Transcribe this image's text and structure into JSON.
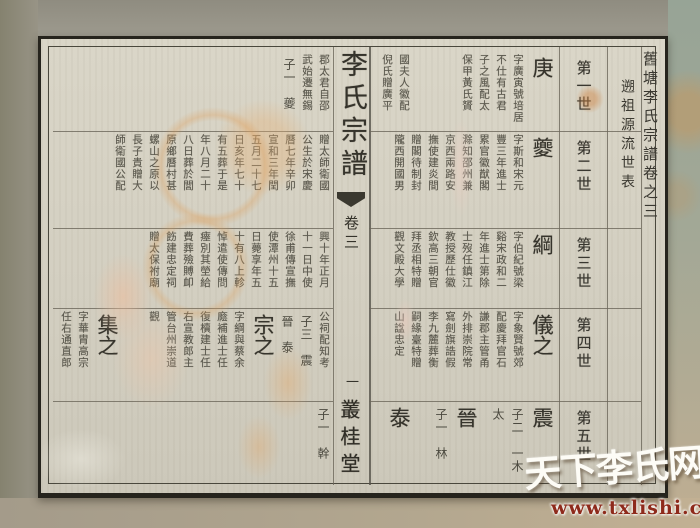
{
  "watermark": {
    "site_name": "天下李氏网",
    "site_url": "www.txlishi.com",
    "url_color": "#8e2a1b"
  },
  "colors": {
    "paper": "#d5d1c3",
    "ink": "#3a382f",
    "stain_orange": "#dca86c",
    "watermark_red": "#8e2a1b"
  },
  "spread": {
    "fold": {
      "book_title": "李氏宗譜",
      "volume_label": "卷三",
      "page_number": "一",
      "hall_name": "叢桂堂"
    },
    "right_page": {
      "edition_title": "舊塘李氏宗譜卷之三",
      "section_title": "遡祖源流世表",
      "generation_labels": [
        "第一世",
        "第二世",
        "第三世",
        "第四世",
        "第五世"
      ],
      "bands": [
        [
          [
            "name",
            "庚"
          ],
          [
            "col",
            "字廣寅號培居"
          ],
          [
            "col",
            "不仕有古君"
          ],
          [
            "col",
            "子之風配太"
          ],
          [
            "col",
            "保甲黃氏贇"
          ],
          [
            "gap",
            "44"
          ],
          [
            "col",
            "國夫人徽配"
          ],
          [
            "col",
            "倪氏贈廣平"
          ]
        ],
        [
          [
            "name",
            "夔"
          ],
          [
            "col",
            "字斯和宋元"
          ],
          [
            "col",
            "豐三年進士"
          ],
          [
            "col",
            "累官徽猷閣"
          ],
          [
            "col",
            "滁知邵州兼"
          ],
          [
            "col",
            "京西兩路安"
          ],
          [
            "col",
            "撫使建炎間"
          ],
          [
            "col",
            "贈閣待制封"
          ],
          [
            "col",
            "隴西開國男"
          ]
        ],
        [
          [
            "name",
            "綱"
          ],
          [
            "col",
            "字伯紀號梁"
          ],
          [
            "col",
            "谿宋政和二"
          ],
          [
            "col",
            "年進士第除"
          ],
          [
            "col",
            "士歿任鎮江"
          ],
          [
            "col",
            "教授歷仕徽"
          ],
          [
            "col",
            "欽高三朝官"
          ],
          [
            "col",
            "拜丞相特贈"
          ],
          [
            "col",
            "觀文殿大學"
          ]
        ],
        [
          [
            "name",
            "儀之"
          ],
          [
            "col",
            "字象賢號郊"
          ],
          [
            "col",
            "配慶拜官石"
          ],
          [
            "col",
            "謙郡主管甬"
          ],
          [
            "col",
            "外排崇院常"
          ],
          [
            "col",
            "寫劍旗誥假"
          ],
          [
            "col",
            "李九麓葬衡"
          ],
          [
            "col",
            "嗣緣臺特贈"
          ],
          [
            "col",
            "山諡忠定"
          ]
        ],
        [
          [
            "name",
            "震"
          ],
          [
            "note",
            "子二　一木"
          ],
          [
            "note",
            "太"
          ],
          [
            "gap",
            "6"
          ],
          [
            "name",
            "晉"
          ],
          [
            "note",
            "子一　林"
          ],
          [
            "gap",
            "16"
          ],
          [
            "name",
            "泰"
          ]
        ]
      ]
    },
    "left_page": {
      "bands": [
        [
          [
            "col",
            "郡太君自邵"
          ],
          [
            "col",
            "武始遷無錫"
          ],
          [
            "note",
            "子一　夔"
          ]
        ],
        [
          [
            "col",
            "贈太師衛國"
          ],
          [
            "col",
            "公生於宋慶"
          ],
          [
            "col",
            "曆七年辛卯"
          ],
          [
            "col",
            "宣和三年閏"
          ],
          [
            "col",
            "五月二十七"
          ],
          [
            "col",
            "日亥年七十"
          ],
          [
            "col",
            "有五葬于是"
          ],
          [
            "col",
            "年八月二十"
          ],
          [
            "col",
            "八日葬於閭"
          ],
          [
            "col",
            "原鄉曆村甚"
          ],
          [
            "col",
            "螺山之原以"
          ],
          [
            "col",
            "長子貴贈大"
          ],
          [
            "col",
            "師衛國公配"
          ]
        ],
        [
          [
            "col",
            "興十年正月"
          ],
          [
            "col",
            "十一日中使"
          ],
          [
            "col",
            "徐甫傳宣撫"
          ],
          [
            "col",
            "使潭州十五"
          ],
          [
            "col",
            "日薨享年五"
          ],
          [
            "col",
            "十有八上軫"
          ],
          [
            "col",
            "悼遣使傳問"
          ],
          [
            "col",
            "瘞別其塋給"
          ],
          [
            "col",
            "費葬殮賻卹"
          ],
          [
            "col",
            "飭建忠定祠"
          ],
          [
            "col",
            "贈太保祔廟"
          ]
        ],
        [
          [
            "col",
            "公祠配知考"
          ],
          [
            "note",
            "子三　震"
          ],
          [
            "note",
            "晉　泰"
          ],
          [
            "name",
            "宗之"
          ],
          [
            "col",
            "字綱與蔡余"
          ],
          [
            "col",
            "廕補進士任"
          ],
          [
            "col",
            "復櫝建士任"
          ],
          [
            "col",
            "右宣教郎主"
          ],
          [
            "col",
            "管台州崇道"
          ],
          [
            "col",
            "觀"
          ],
          [
            "gap",
            "22"
          ],
          [
            "name",
            "集之"
          ],
          [
            "col",
            "字華胄高宗"
          ],
          [
            "col",
            "任右通直郎"
          ]
        ],
        [
          [
            "note",
            "子一　幹"
          ]
        ]
      ]
    }
  }
}
